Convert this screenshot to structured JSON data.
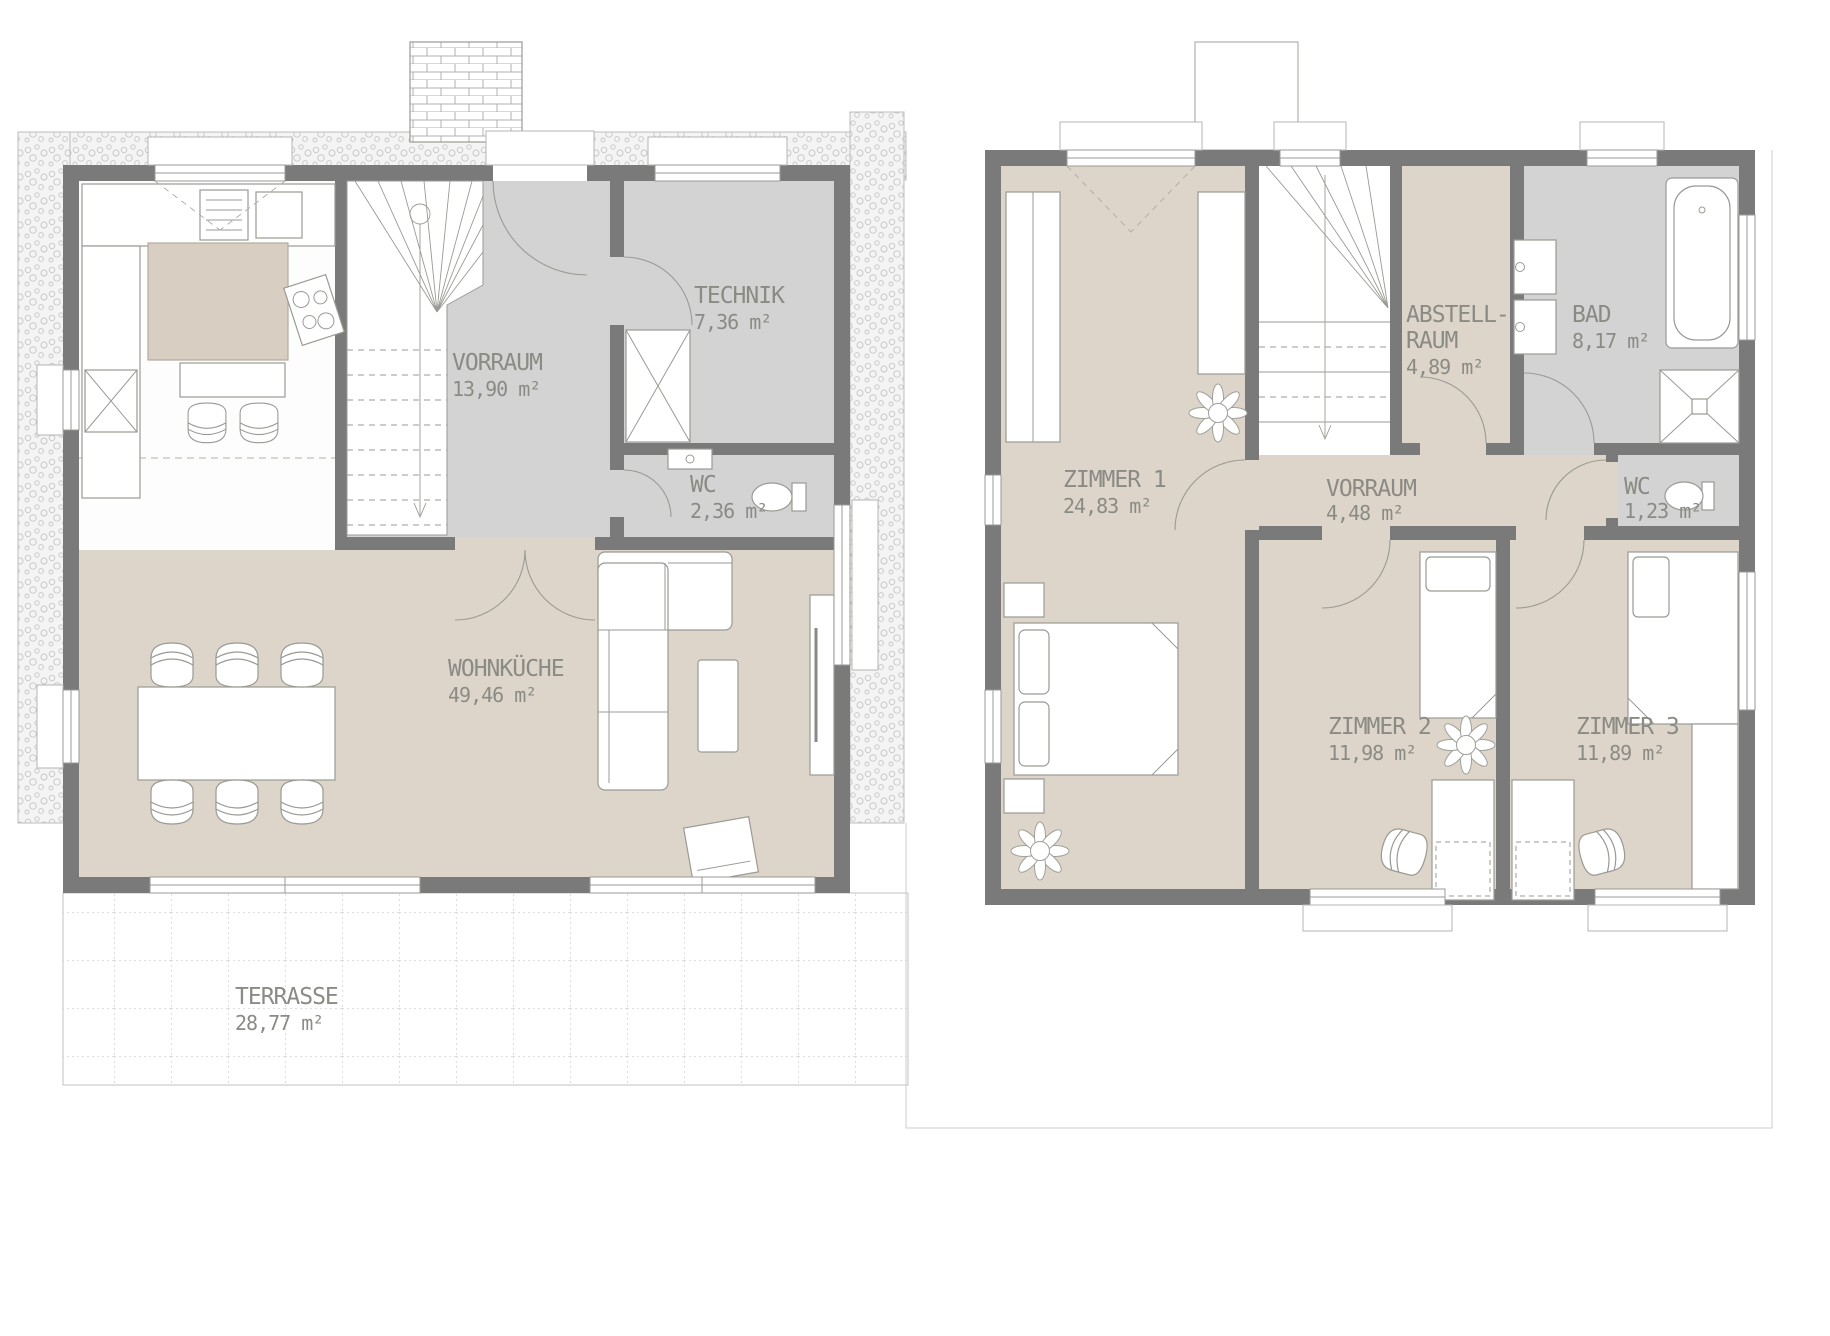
{
  "plans": {
    "ground_floor": {
      "rooms": {
        "wohnkueche": {
          "name": "WOHNKÜCHE",
          "area": "49,46 m²"
        },
        "vorraum": {
          "name": "VORRAUM",
          "area": "13,90 m²"
        },
        "technik": {
          "name": "TECHNIK",
          "area": "7,36 m²"
        },
        "wc": {
          "name": "WC",
          "area": "2,36 m²"
        },
        "terrasse": {
          "name": "TERRASSE",
          "area": "28,77 m²"
        }
      }
    },
    "upper_floor": {
      "rooms": {
        "zimmer1": {
          "name": "ZIMMER 1",
          "area": "24,83 m²"
        },
        "abstellraum": {
          "name_line1": "ABSTELL-",
          "name_line2": "RAUM",
          "area": "4,89 m²"
        },
        "bad": {
          "name": "BAD",
          "area": "8,17 m²"
        },
        "vorraum": {
          "name": "VORRAUM",
          "area": "4,48 m²"
        },
        "wc": {
          "name": "WC",
          "area": "1,23 m²"
        },
        "zimmer2": {
          "name": "ZIMMER 2",
          "area": "11,98 m²"
        },
        "zimmer3": {
          "name": "ZIMMER 3",
          "area": "11,89 m²"
        }
      }
    }
  },
  "colors": {
    "wall": "#7a7a7a",
    "floor_beige": "#ddd5c9",
    "floor_gray": "#d3d3d3",
    "label_text": "#8b8b85",
    "hatch_dot": "#c6c6c6"
  }
}
